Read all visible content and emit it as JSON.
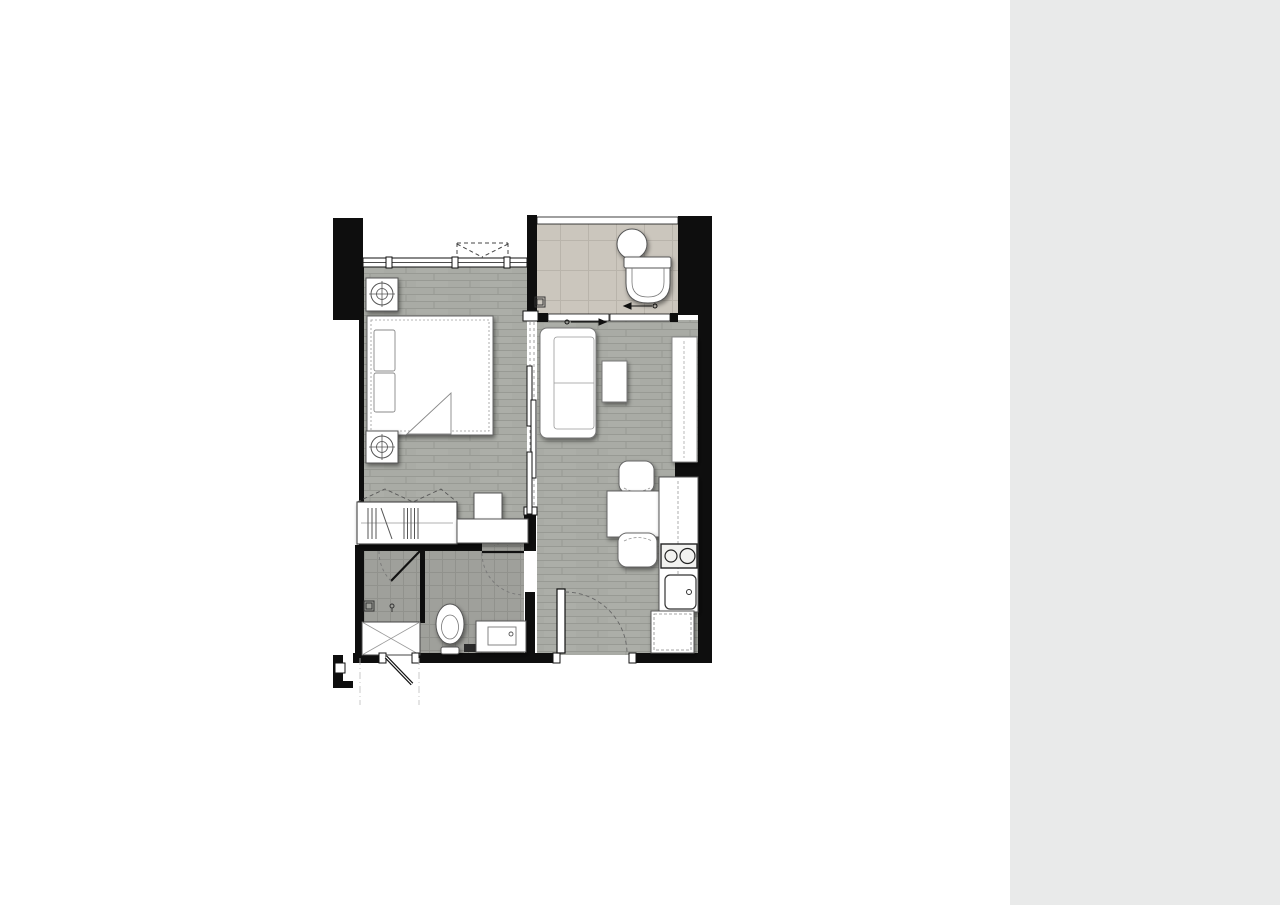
{
  "side_panel": {
    "background": "#e9eaea",
    "logo_card": {
      "background": "#87cdc6",
      "line1": "LUXE",
      "line2": "ELEMENTS",
      "brand": "AERAS",
      "brand_display": "ΛΞRAS"
    },
    "unit": {
      "code": "A1",
      "area": "35 sq.m."
    },
    "developer": {
      "word1": "THE",
      "word2": "URBAN",
      "line2": "PROPERTY",
      "tagline": "Redefining Designed Living"
    }
  },
  "floor_plan": {
    "colors": {
      "wall": "#0e0e0e",
      "wood_floor": "#a9aba5",
      "tile_beige": "#cbc6bd",
      "tile_gray": "#9fa09b"
    },
    "rooms": [
      "bedroom",
      "bathroom",
      "living-dining",
      "kitchen",
      "shower-room",
      "entrance"
    ],
    "furniture": [
      "bed",
      "nightstands-with-lamps",
      "wardrobe",
      "sofa",
      "coffee-table",
      "tv-cabinet",
      "dining-table",
      "chairs",
      "stove",
      "kitchen-sink",
      "refrigerator-cabinet",
      "washbasin",
      "toilet",
      "shower",
      "vanity"
    ]
  }
}
